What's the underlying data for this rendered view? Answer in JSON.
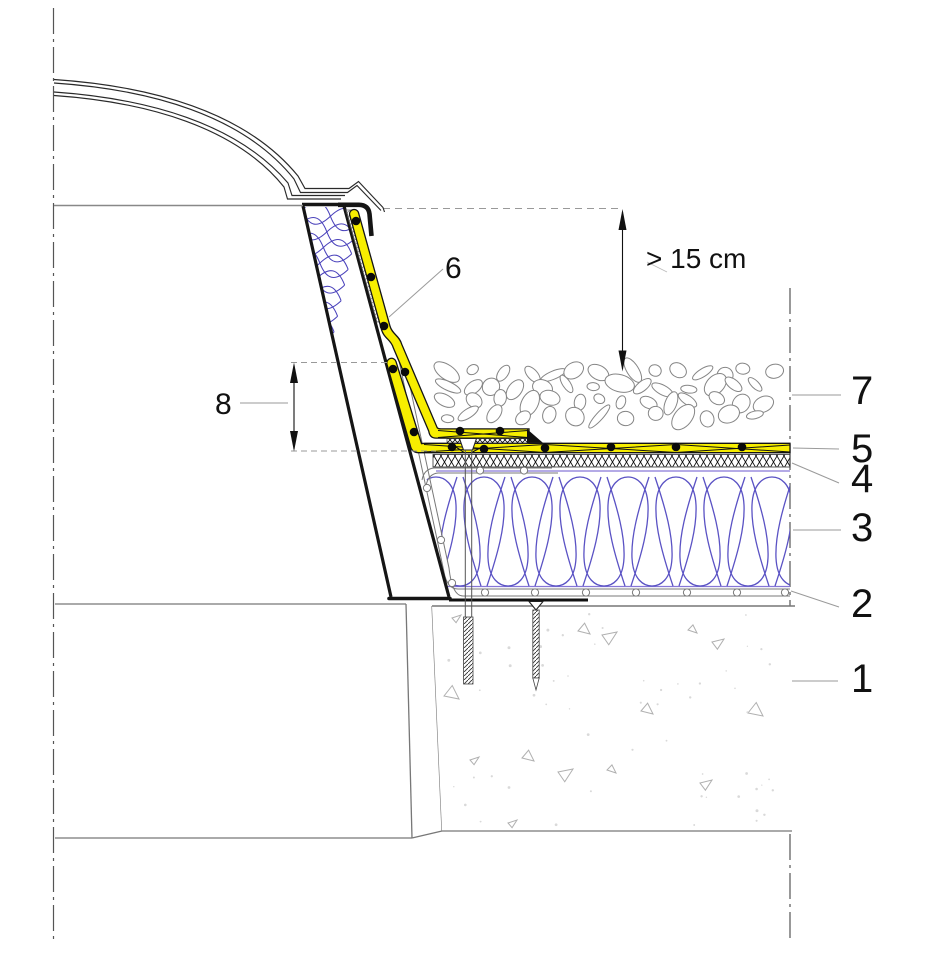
{
  "drawing": {
    "callouts": [
      {
        "label": "1"
      },
      {
        "label": "2"
      },
      {
        "label": "3"
      },
      {
        "label": "4"
      },
      {
        "label": "5"
      },
      {
        "label": "6"
      },
      {
        "label": "7"
      },
      {
        "label": "8"
      }
    ],
    "dimensions": {
      "gravel_min": "> 15 cm"
    },
    "colors": {
      "membrane_yellow": "#f7ee00",
      "insulation_blue": "#5a52c4",
      "facer_purple": "#8677d6",
      "curb_hatch_blue": "#4a42bb",
      "outline_black": "#151515",
      "line_gray": "#808080",
      "leader_gray": "#9a9a9a"
    }
  }
}
